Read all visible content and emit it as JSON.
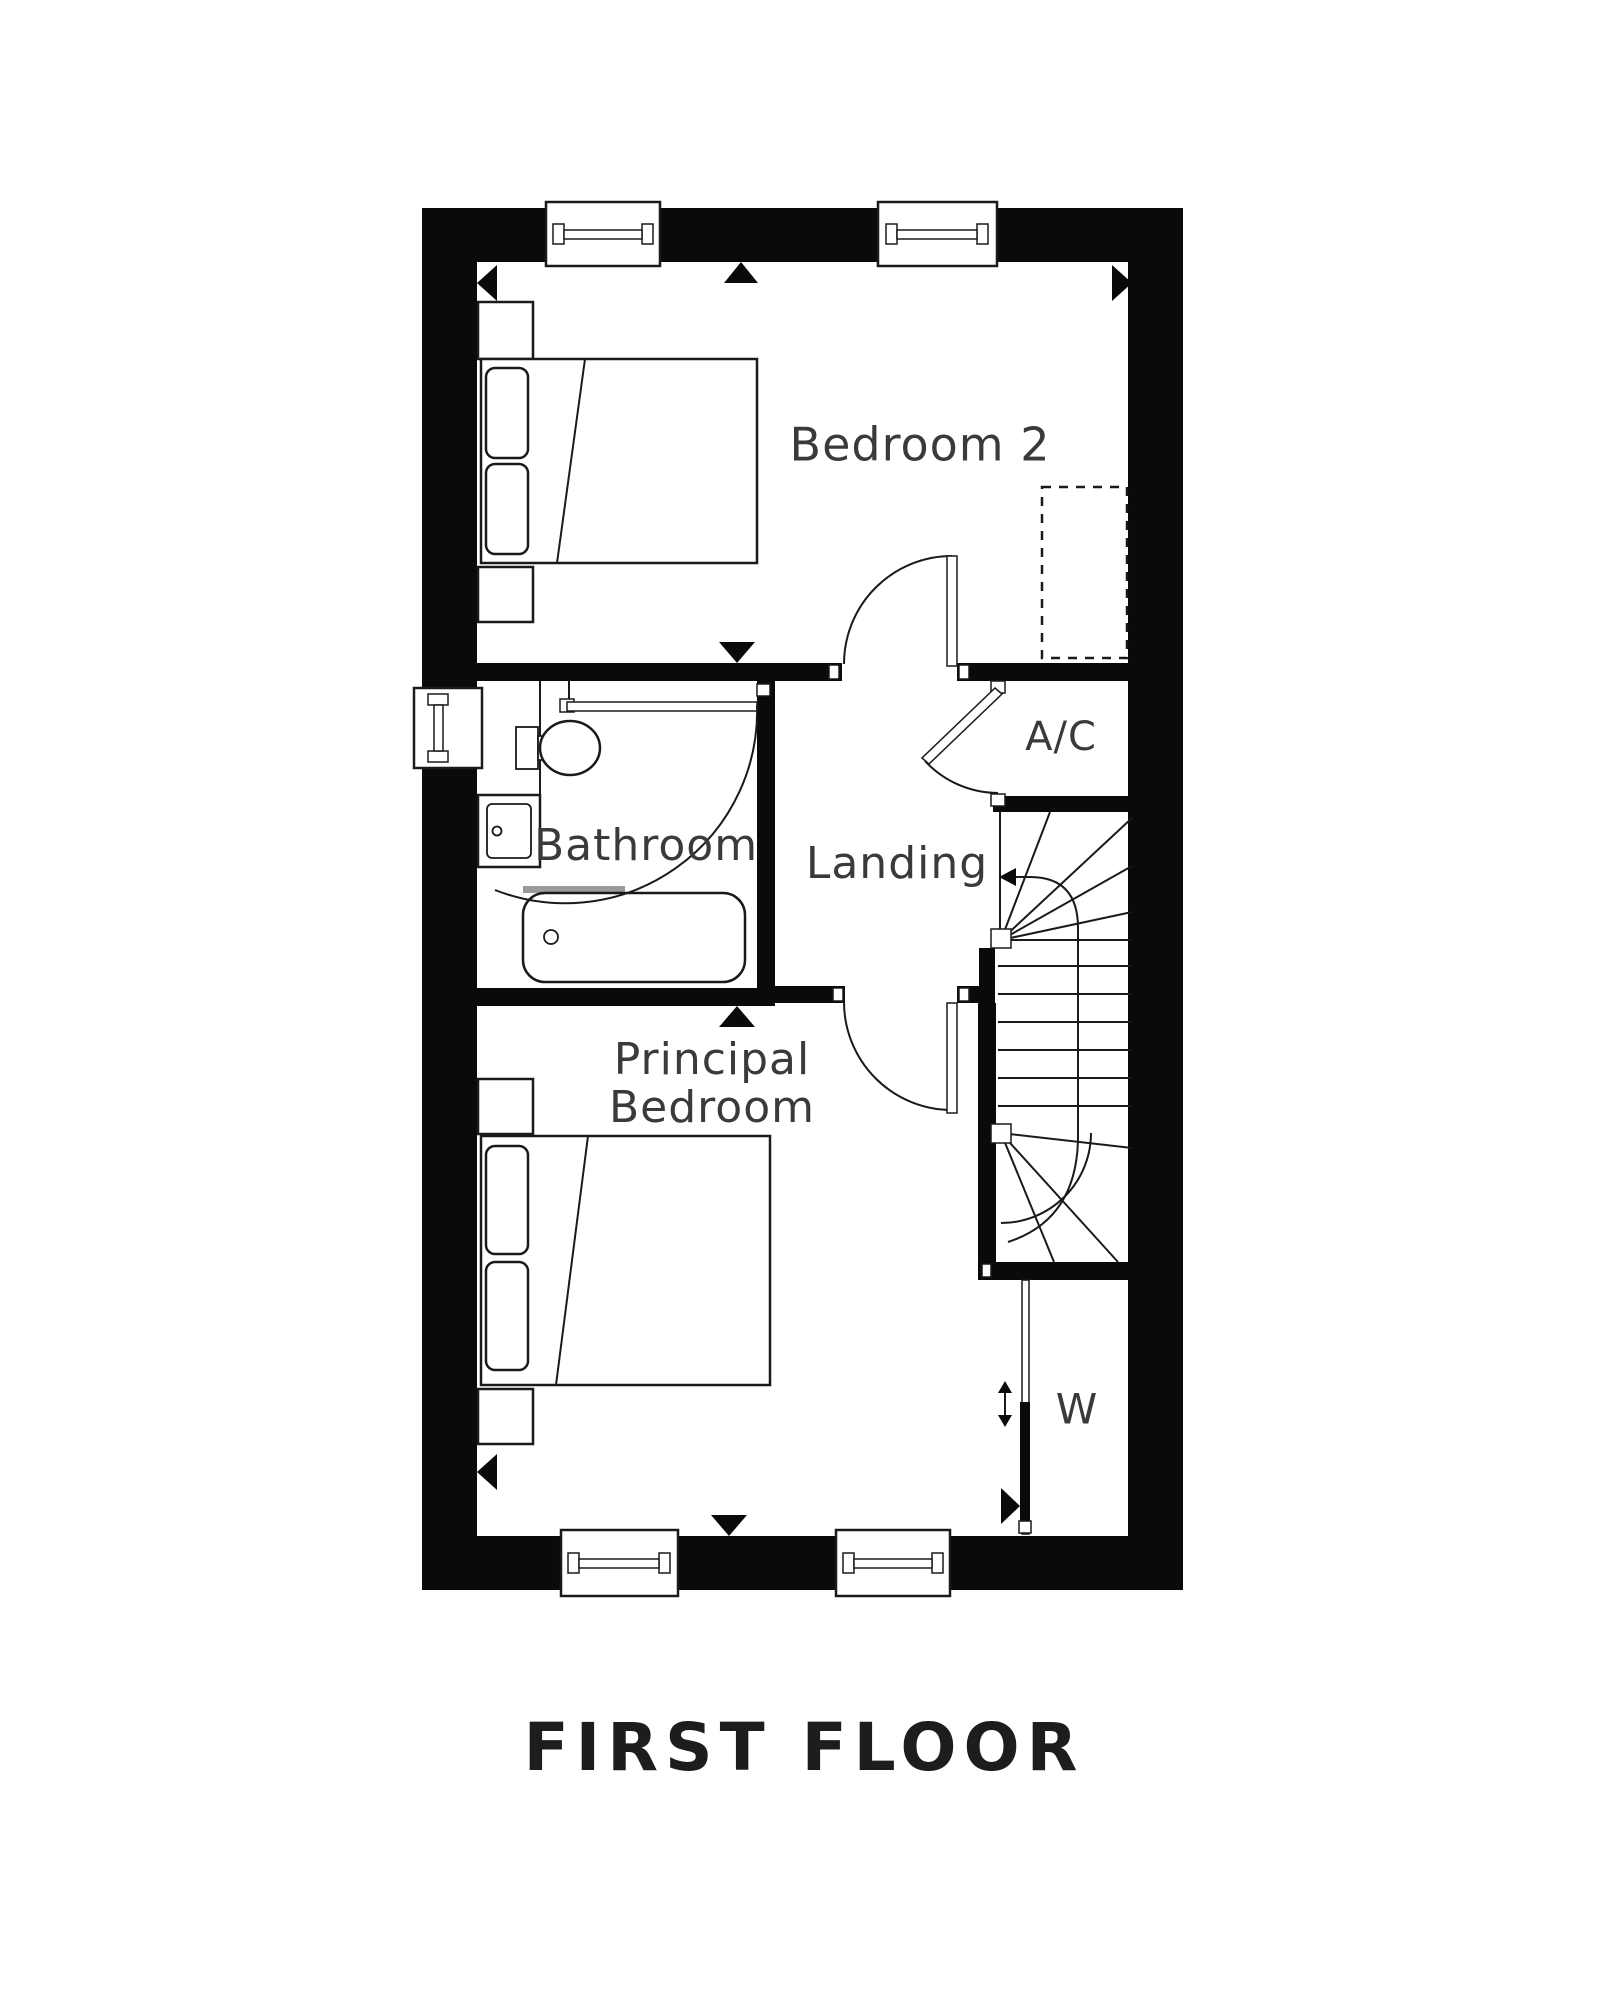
{
  "plan": {
    "title": "FIRST FLOOR",
    "rooms": [
      {
        "id": "bedroom-2",
        "label": "Bedroom 2"
      },
      {
        "id": "bathroom",
        "label": "Bathroom"
      },
      {
        "id": "landing",
        "label": "Landing"
      },
      {
        "id": "ac-cupboard",
        "label": "A/C"
      },
      {
        "id": "principal-bedroom",
        "label_line1": "Principal",
        "label_line2": "Bedroom"
      },
      {
        "id": "wardrobe",
        "label": "W"
      }
    ],
    "symbols": [
      "double-bed",
      "pillows",
      "bedside-table",
      "toilet",
      "basin",
      "bath",
      "window",
      "door-swing",
      "sliding-door",
      "staircase",
      "direction-arrow",
      "dashed-furniture-zone",
      "dimension-markers"
    ],
    "colors": {
      "wall": "#0a0a0a",
      "line": "#1a1a1a",
      "label": "#3a3a3a",
      "shower_screen": "#9a9a9a",
      "background": "#ffffff"
    }
  }
}
